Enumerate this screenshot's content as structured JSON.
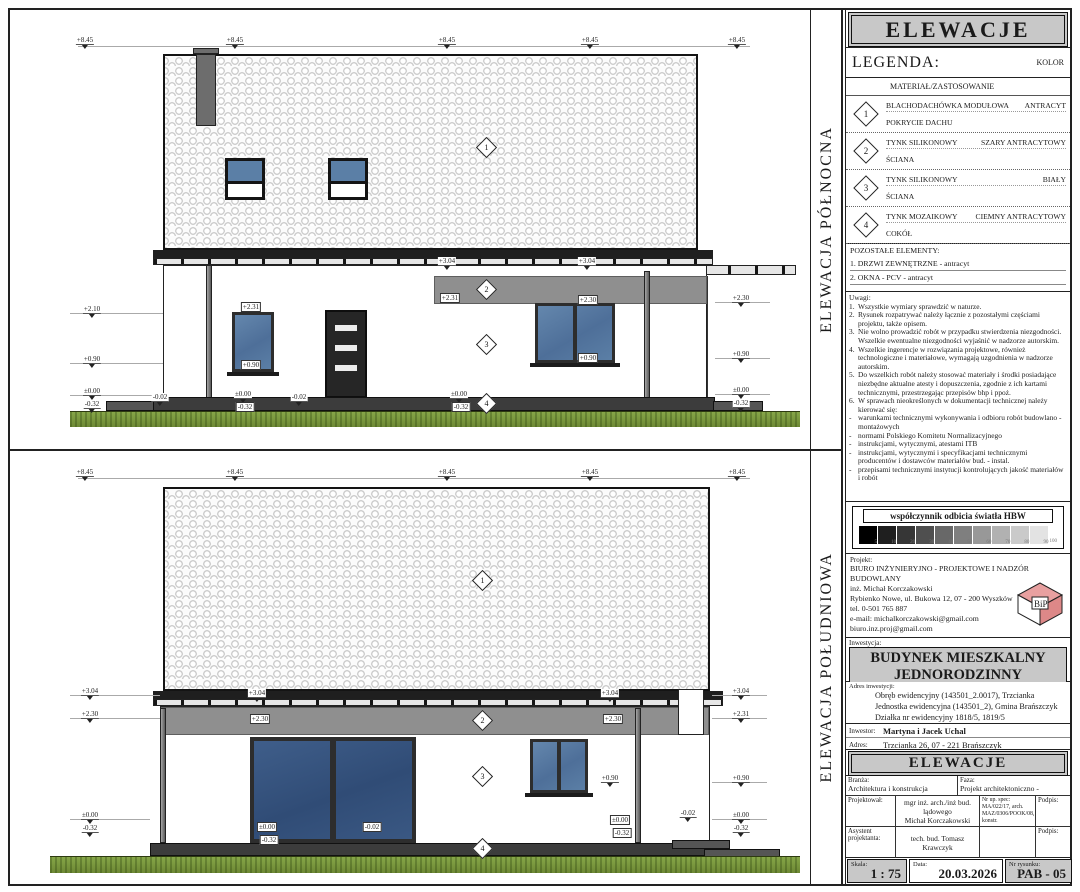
{
  "north": {
    "vertical_label": "ELEWACJA PÓŁNOCNA",
    "dims": [
      {
        "t": "+8.45",
        "x": 75,
        "y": 26
      },
      {
        "t": "+8.45",
        "x": 225,
        "y": 26
      },
      {
        "t": "+8.45",
        "x": 437,
        "y": 26
      },
      {
        "t": "+8.45",
        "x": 580,
        "y": 26
      },
      {
        "t": "+8.45",
        "x": 727,
        "y": 26
      },
      {
        "t": "+3.04",
        "x": 437,
        "y": 247
      },
      {
        "t": "+3.04",
        "x": 577,
        "y": 247
      },
      {
        "t": "+2.31",
        "x": 440,
        "y": 283,
        "b": 1
      },
      {
        "t": "+2.31",
        "x": 241,
        "y": 292,
        "b": 1
      },
      {
        "t": "+0.90",
        "x": 241,
        "y": 350,
        "b": 1
      },
      {
        "t": "+2.30",
        "x": 578,
        "y": 285,
        "b": 1
      },
      {
        "t": "+0.90",
        "x": 578,
        "y": 343,
        "b": 1
      },
      {
        "t": "+2.10",
        "x": 82,
        "y": 295
      },
      {
        "t": "+0.90",
        "x": 82,
        "y": 345
      },
      {
        "t": "±0.00",
        "x": 82,
        "y": 377
      },
      {
        "t": "-0.32",
        "x": 82,
        "y": 390
      },
      {
        "t": "-0.02",
        "x": 150,
        "y": 383
      },
      {
        "t": "±0.00",
        "x": 233,
        "y": 380
      },
      {
        "t": "-0.32",
        "x": 235,
        "y": 392,
        "b": 1
      },
      {
        "t": "-0.02",
        "x": 289,
        "y": 383
      },
      {
        "t": "±0.00",
        "x": 449,
        "y": 380
      },
      {
        "t": "-0.32",
        "x": 451,
        "y": 392,
        "b": 1
      },
      {
        "t": "+2.30",
        "x": 731,
        "y": 284
      },
      {
        "t": "+0.90",
        "x": 731,
        "y": 340
      },
      {
        "t": "±0.00",
        "x": 731,
        "y": 376
      },
      {
        "t": "-0.32",
        "x": 731,
        "y": 389
      }
    ],
    "diamonds": [
      {
        "n": "1",
        "x": 469,
        "y": 130
      },
      {
        "n": "2",
        "x": 469,
        "y": 272
      },
      {
        "n": "3",
        "x": 469,
        "y": 327
      },
      {
        "n": "4",
        "x": 469,
        "y": 386
      }
    ]
  },
  "south": {
    "vertical_label": "ELEWACJA POŁUDNIOWA",
    "dims": [
      {
        "t": "+8.45",
        "x": 75,
        "y": 17
      },
      {
        "t": "+8.45",
        "x": 225,
        "y": 17
      },
      {
        "t": "+8.45",
        "x": 437,
        "y": 17
      },
      {
        "t": "+8.45",
        "x": 580,
        "y": 17
      },
      {
        "t": "+8.45",
        "x": 727,
        "y": 17
      },
      {
        "t": "+3.04",
        "x": 80,
        "y": 236
      },
      {
        "t": "+2.30",
        "x": 80,
        "y": 259
      },
      {
        "t": "±0.00",
        "x": 80,
        "y": 360
      },
      {
        "t": "-0.32",
        "x": 80,
        "y": 373
      },
      {
        "t": "+3.04",
        "x": 247,
        "y": 238
      },
      {
        "t": "+3.04",
        "x": 600,
        "y": 238
      },
      {
        "t": "+2.30",
        "x": 250,
        "y": 263,
        "b": 1
      },
      {
        "t": "+2.30",
        "x": 603,
        "y": 263,
        "b": 1
      },
      {
        "t": "±0.00",
        "x": 257,
        "y": 371,
        "b": 1
      },
      {
        "t": "-0.02",
        "x": 362,
        "y": 371,
        "b": 1
      },
      {
        "t": "-0.32",
        "x": 259,
        "y": 384,
        "b": 1
      },
      {
        "t": "+0.90",
        "x": 600,
        "y": 323
      },
      {
        "t": "±0.00",
        "x": 610,
        "y": 364,
        "b": 1
      },
      {
        "t": "-0.32",
        "x": 612,
        "y": 377,
        "b": 1
      },
      {
        "t": "-0.02",
        "x": 678,
        "y": 358
      },
      {
        "t": "+3.04",
        "x": 731,
        "y": 236
      },
      {
        "t": "+2.31",
        "x": 731,
        "y": 259
      },
      {
        "t": "+0.90",
        "x": 731,
        "y": 323
      },
      {
        "t": "±0.00",
        "x": 731,
        "y": 360
      },
      {
        "t": "-0.32",
        "x": 731,
        "y": 373
      }
    ],
    "diamonds": [
      {
        "n": "1",
        "x": 465,
        "y": 122
      },
      {
        "n": "2",
        "x": 465,
        "y": 262
      },
      {
        "n": "3",
        "x": 465,
        "y": 318
      },
      {
        "n": "4",
        "x": 465,
        "y": 390
      }
    ]
  },
  "titleblock": {
    "header": "ELEWACJE",
    "legend": {
      "title": "LEGENDA:",
      "color_header": "KOLOR",
      "column_header": "MATERIAŁ/ZASTOSOWANIE",
      "items": [
        {
          "n": "1",
          "material": "BLACHODACHÓWKA MODUŁOWA",
          "application": "POKRYCIE DACHU",
          "color": "ANTRACYT"
        },
        {
          "n": "2",
          "material": "TYNK SILIKONOWY",
          "application": "ŚCIANA",
          "color": "SZARY ANTRACYTOWY"
        },
        {
          "n": "3",
          "material": "TYNK SILIKONOWY",
          "application": "ŚCIANA",
          "color": "BIAŁY"
        },
        {
          "n": "4",
          "material": "TYNK MOZAIKOWY",
          "application": "COKÓŁ",
          "color": "CIEMNY ANTRACYTOWY"
        }
      ]
    },
    "pozostale": {
      "title": "POZOSTAŁE ELEMENTY:",
      "lines": [
        "1. DRZWI ZEWNĘTRZNE - antracyt",
        "2. OKNA - PCV - antracyt"
      ]
    },
    "uwagi": {
      "title": "Uwagi:",
      "items": [
        {
          "n": "1.",
          "t": "Wszystkie wymiary sprawdzić w naturze."
        },
        {
          "n": "2.",
          "t": "Rysunek rozpatrywać należy łącznie z pozostałymi częściami projektu, także opisem."
        },
        {
          "n": "3.",
          "t": "Nie wolno prowadzić robót w przypadku stwierdzenia niezgodności. Wszelkie ewentualne niezgodności wyjaśnić w nadzorze autorskim."
        },
        {
          "n": "4.",
          "t": "Wszelkie ingerencje w rozwiązania projektowe, również technologiczne i materiałowe, wymagają uzgodnienia w nadzorze autorskim."
        },
        {
          "n": "5.",
          "t": "Do wszelkich robót należy stosować materiały i środki posiadające niezbędne aktualne atesty i dopuszczenia, zgodnie z ich kartami technicznymi, przestrzegając przepisów bhp i ppoż."
        },
        {
          "n": "6.",
          "t": "W sprawach nieokreślonych w dokumentacji technicznej należy kierować się:"
        }
      ],
      "bullets": [
        "warunkami technicznymi wykonywania i odbioru robót budowlano - montażowych",
        "normami Polskiego Komitetu Normalizacyjnego",
        "instrukcjami, wytycznymi, atestami ITB",
        "instrukcjami, wytycznymi i specyfikacjami technicznymi producentów i dostawców materiałów bud. - instal.",
        "przepisami technicznymi instytucji kontrolujących jakość materiałów i robót"
      ]
    },
    "hbw": {
      "title": "współczynnik odbicia światła HBW",
      "values": [
        "5",
        "10",
        "20",
        "30",
        "40",
        "50",
        "60",
        "70",
        "80",
        "90",
        "100"
      ],
      "swatches": [
        "#000000",
        "#1f1f1f",
        "#363636",
        "#4f4f4f",
        "#686868",
        "#7f7f7f",
        "#989898",
        "#b1b1b1",
        "#cacaca",
        "#e3e3e3"
      ]
    },
    "projekt": {
      "label": "Projekt:",
      "lines": [
        "BIURO INŻYNIERYJNO - PROJEKTOWE I NADZÓR BUDOWLANY",
        "inż. Michał Korczakowski",
        "Rybienko Nowe, ul. Bukowa 12, 07 - 200 Wyszków",
        "tel. 0-501 765 887",
        "e-mail: michalkorczakowski@gmail.com",
        "        biuro.inz.proj@gmail.com"
      ]
    },
    "inwestycja": {
      "label": "Inwestycja:",
      "title_line1": "BUDYNEK MIESZKALNY",
      "title_line2": "JEDNORODZINNY",
      "address_label": "Adres inwestycji:",
      "address_lines": [
        "Obręb ewidencyjny (143501_2.0017), Trzcianka",
        "Jednostka ewidencyjna (143501_2), Gmina Brańszczyk",
        "Działka nr ewidencyjny 1818/5, 1819/5"
      ],
      "inwestor_label": "Inwestor:",
      "inwestor": "Martyna i Jacek Uchal",
      "adres_label": "Adres:",
      "adres": "Trzcianka 26, 07 - 221 Brańszczyk"
    },
    "drawing_title": "ELEWACJE",
    "table": {
      "branza_label": "Branża:",
      "branza": "Architektura i konstrukcja",
      "faza_label": "Faza:",
      "faza": "Projekt architektoniczno - budowlany",
      "projektowal_label": "Projektował:",
      "projektowal_line1": "mgr inż. arch./inż bud. lądowego",
      "projektowal_line2": "Michał Korczakowski",
      "nr_up_lines": [
        "Nr up. spec:",
        "MA/022/17, arch.",
        "MAZ/0306/POOK/08, konstr."
      ],
      "podpis_label": "Podpis:",
      "asystent_label": "Asystent projektanta:",
      "asystent": "tech. bud. Tomasz Krawczyk",
      "podpis2_label": "Podpis:"
    },
    "footer": {
      "skala_label": "Skala:",
      "skala": "1 : 75",
      "data_label": "Data:",
      "data": "20.03.2026",
      "nr_label": "Nr rysunku:",
      "nr": "PAB - 05"
    }
  }
}
